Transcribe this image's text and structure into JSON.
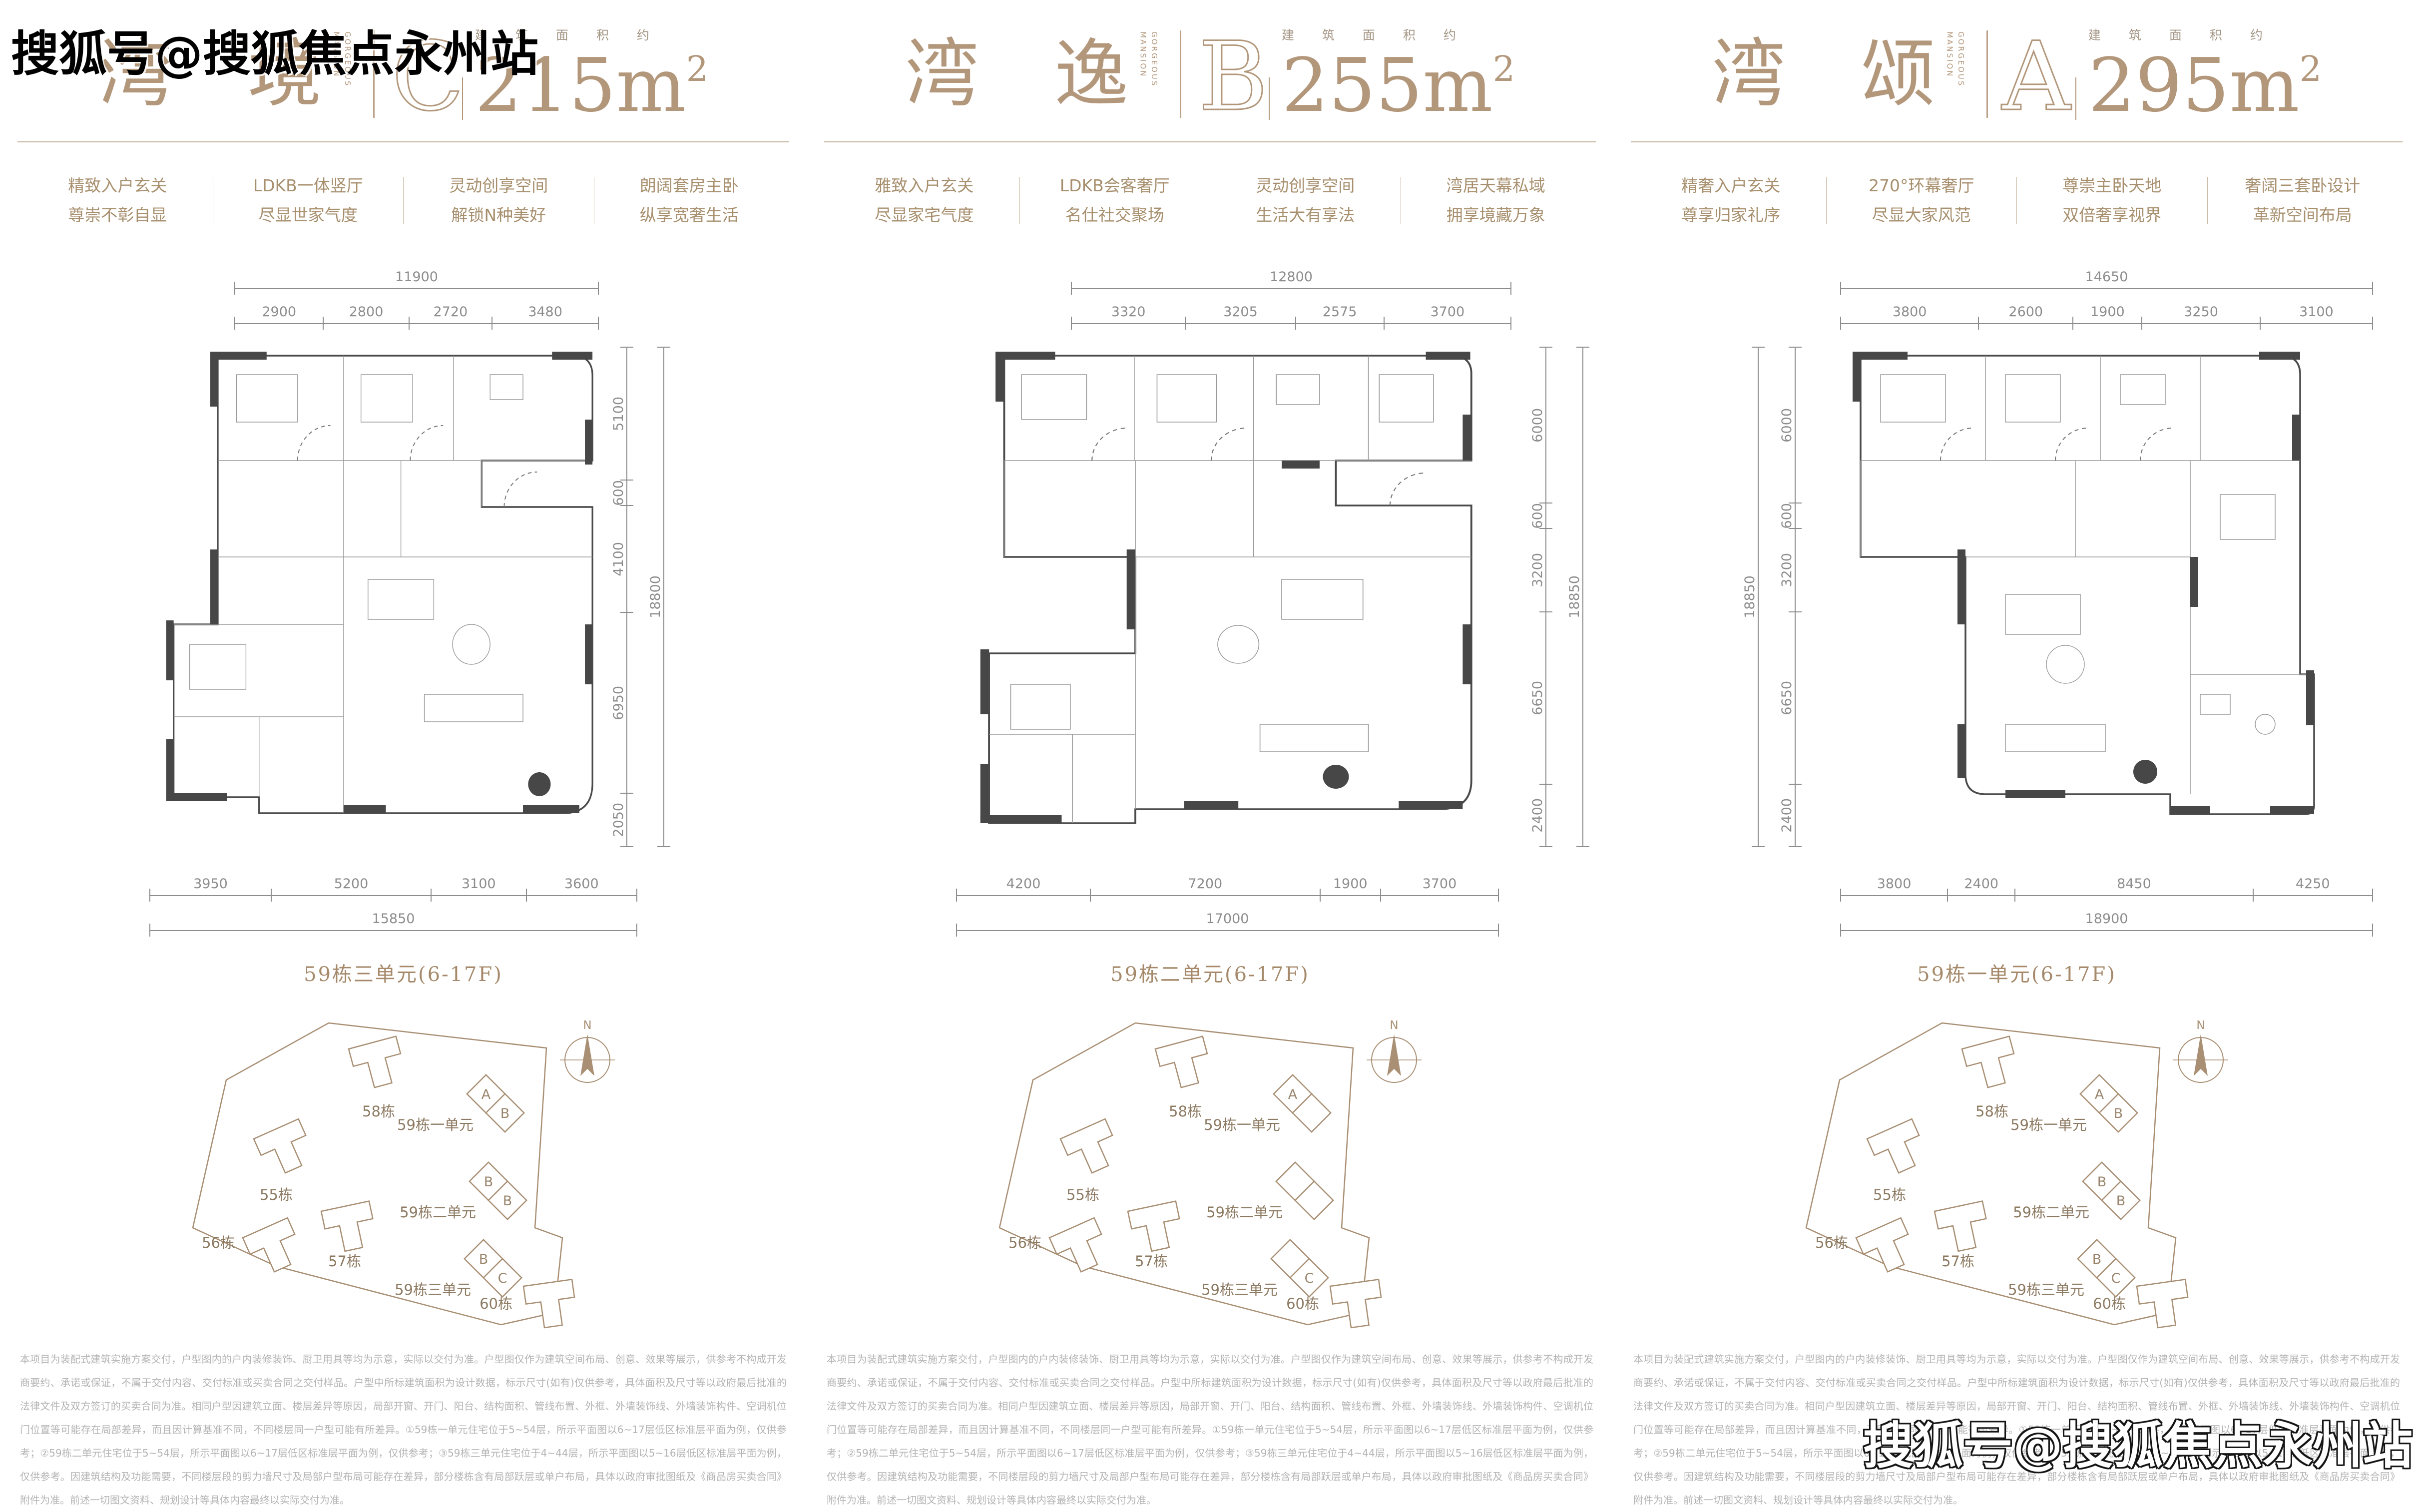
{
  "watermark": {
    "text": "搜狐号@搜狐焦点永州站"
  },
  "shared": {
    "area_caption": "建筑面积约",
    "subtitle_en": "GORGEOUS\nMANSION",
    "north_label": "N",
    "colors": {
      "title_tan": "#b3977b",
      "feature_tan": "#a8906f",
      "dim_gray": "#8d8d8d",
      "wall_dark": "#474747",
      "site_outline": "#a98f74",
      "disclaimer_gray": "#b3b3b3"
    },
    "site": {
      "buildings": [
        "58栋",
        "55栋",
        "56栋",
        "57栋",
        "60栋"
      ],
      "units": [
        {
          "name": "59栋一单元",
          "cells": [
            "A",
            "B"
          ]
        },
        {
          "name": "59栋二单元",
          "cells": [
            "B",
            "B"
          ]
        },
        {
          "name": "59栋三单元",
          "cells": [
            "B",
            "C"
          ]
        }
      ]
    },
    "disclaimer": "本项目为装配式建筑实施方案交付，户型图内的户内装修装饰、厨卫用具等均为示意，实际以交付为准。户型图仅作为建筑空间布局、创意、效果等展示，供参考不构成开发商要约、承诺或保证，不属于交付内容、交付标准或买卖合同之交付样品。户型中所标建筑面积为设计数据，标示尺寸(如有)仅供参考，具体面积及尺寸等以政府最后批准的法律文件及双方签订的买卖合同为准。相同户型因建筑立面、楼层差异等原因，局部开窗、开门、阳台、结构面积、管线布置、外框、外墙装饰线、外墙装饰构件、空调机位门位置等可能存在局部差异，而且因计算基准不同，不同楼层同一户型可能有所差异。①59栋一单元住宅位于5~54层，所示平面图以6~17层低区标准层平面为例，仅供参考；②59栋二单元住宅位于5~54层，所示平面图以6~17层低区标准层平面为例，仅供参考；③59栋三单元住宅位于4~44层，所示平面图以5~16层低区标准层平面为例，仅供参考。因建筑结构及功能需要，不同楼层段的剪力墙尺寸及局部户型布局可能存在差异，部分楼栋含有局部跃层或单户布局，具体以政府审批图纸及《商品房买卖合同》附件为准。前述一切图文资料、规划设计等具体内容最终以实际交付为准。"
  },
  "columns": [
    {
      "name": "湾 境",
      "letter": "C",
      "area": "215",
      "area_unit": "m",
      "area_sup": "2",
      "features": [
        {
          "l1": "精致入户玄关",
          "l2": "尊崇不彰自显"
        },
        {
          "l1": "LDKB一体竖厅",
          "l2": "尽显世家气度"
        },
        {
          "l1": "灵动创享空间",
          "l2": "解锁N种美好"
        },
        {
          "l1": "朗阔套房主卧",
          "l2": "纵享宽奢生活"
        }
      ],
      "plan": {
        "top_total": "11900",
        "top_segs": [
          2900,
          2800,
          2720,
          3480
        ],
        "side_total": "18800",
        "side_segs": [
          5100,
          600,
          4100,
          6950,
          2050
        ],
        "bottom_segs": [
          3950,
          5200,
          3100,
          3600
        ],
        "bottom_total": "15850",
        "label": "59栋三单元(6-17F)"
      },
      "highlight": {
        "unit": "59栋三单元",
        "cell": "C",
        "color": "#8b6f50",
        "text_color": "#ffffff"
      }
    },
    {
      "name": "湾 逸",
      "letter": "B",
      "area": "255",
      "area_unit": "m",
      "area_sup": "2",
      "features": [
        {
          "l1": "雅致入户玄关",
          "l2": "尽显家宅气度"
        },
        {
          "l1": "LDKB会客奢厅",
          "l2": "名仕社交聚场"
        },
        {
          "l1": "灵动创享空间",
          "l2": "生活大有享法"
        },
        {
          "l1": "湾居天幕私域",
          "l2": "拥享境藏万象"
        }
      ],
      "plan": {
        "top_total": "12800",
        "top_segs": [
          3320,
          3205,
          2575,
          3700
        ],
        "side_total": "18850",
        "side_segs": [
          6000,
          600,
          3200,
          6650,
          2400
        ],
        "bottom_segs": [
          4200,
          7200,
          1900,
          3700
        ],
        "bottom_total": "17000",
        "label": "59栋二单元(6-17F)"
      },
      "highlight": {
        "unit": "59栋 B户型",
        "cell": "B",
        "color": "#d9c9a4",
        "text_color": "#ffffff"
      }
    },
    {
      "name": "湾 颂",
      "letter": "A",
      "area": "295",
      "area_unit": "m",
      "area_sup": "2",
      "features": [
        {
          "l1": "精奢入户玄关",
          "l2": "尊享归家礼序"
        },
        {
          "l1": "270°环幕奢厅",
          "l2": "尽显大家风范"
        },
        {
          "l1": "尊崇主卧天地",
          "l2": "双倍奢享视界"
        },
        {
          "l1": "奢阔三套卧设计",
          "l2": "革新空间布局"
        }
      ],
      "plan": {
        "top_total": "14650",
        "top_segs": [
          3800,
          2600,
          1900,
          3250,
          3100
        ],
        "side_total": "18850",
        "side_segs": [
          6000,
          600,
          3200,
          6650,
          2400
        ],
        "bottom_segs": [
          3800,
          2400,
          8450,
          4250
        ],
        "bottom_total": "18900",
        "label": "59栋一单元(6-17F)"
      },
      "highlight": {
        "unit": "59栋一单元",
        "cell": "A",
        "color": "#a6b9bd",
        "text_color": "#5f7175"
      }
    }
  ]
}
